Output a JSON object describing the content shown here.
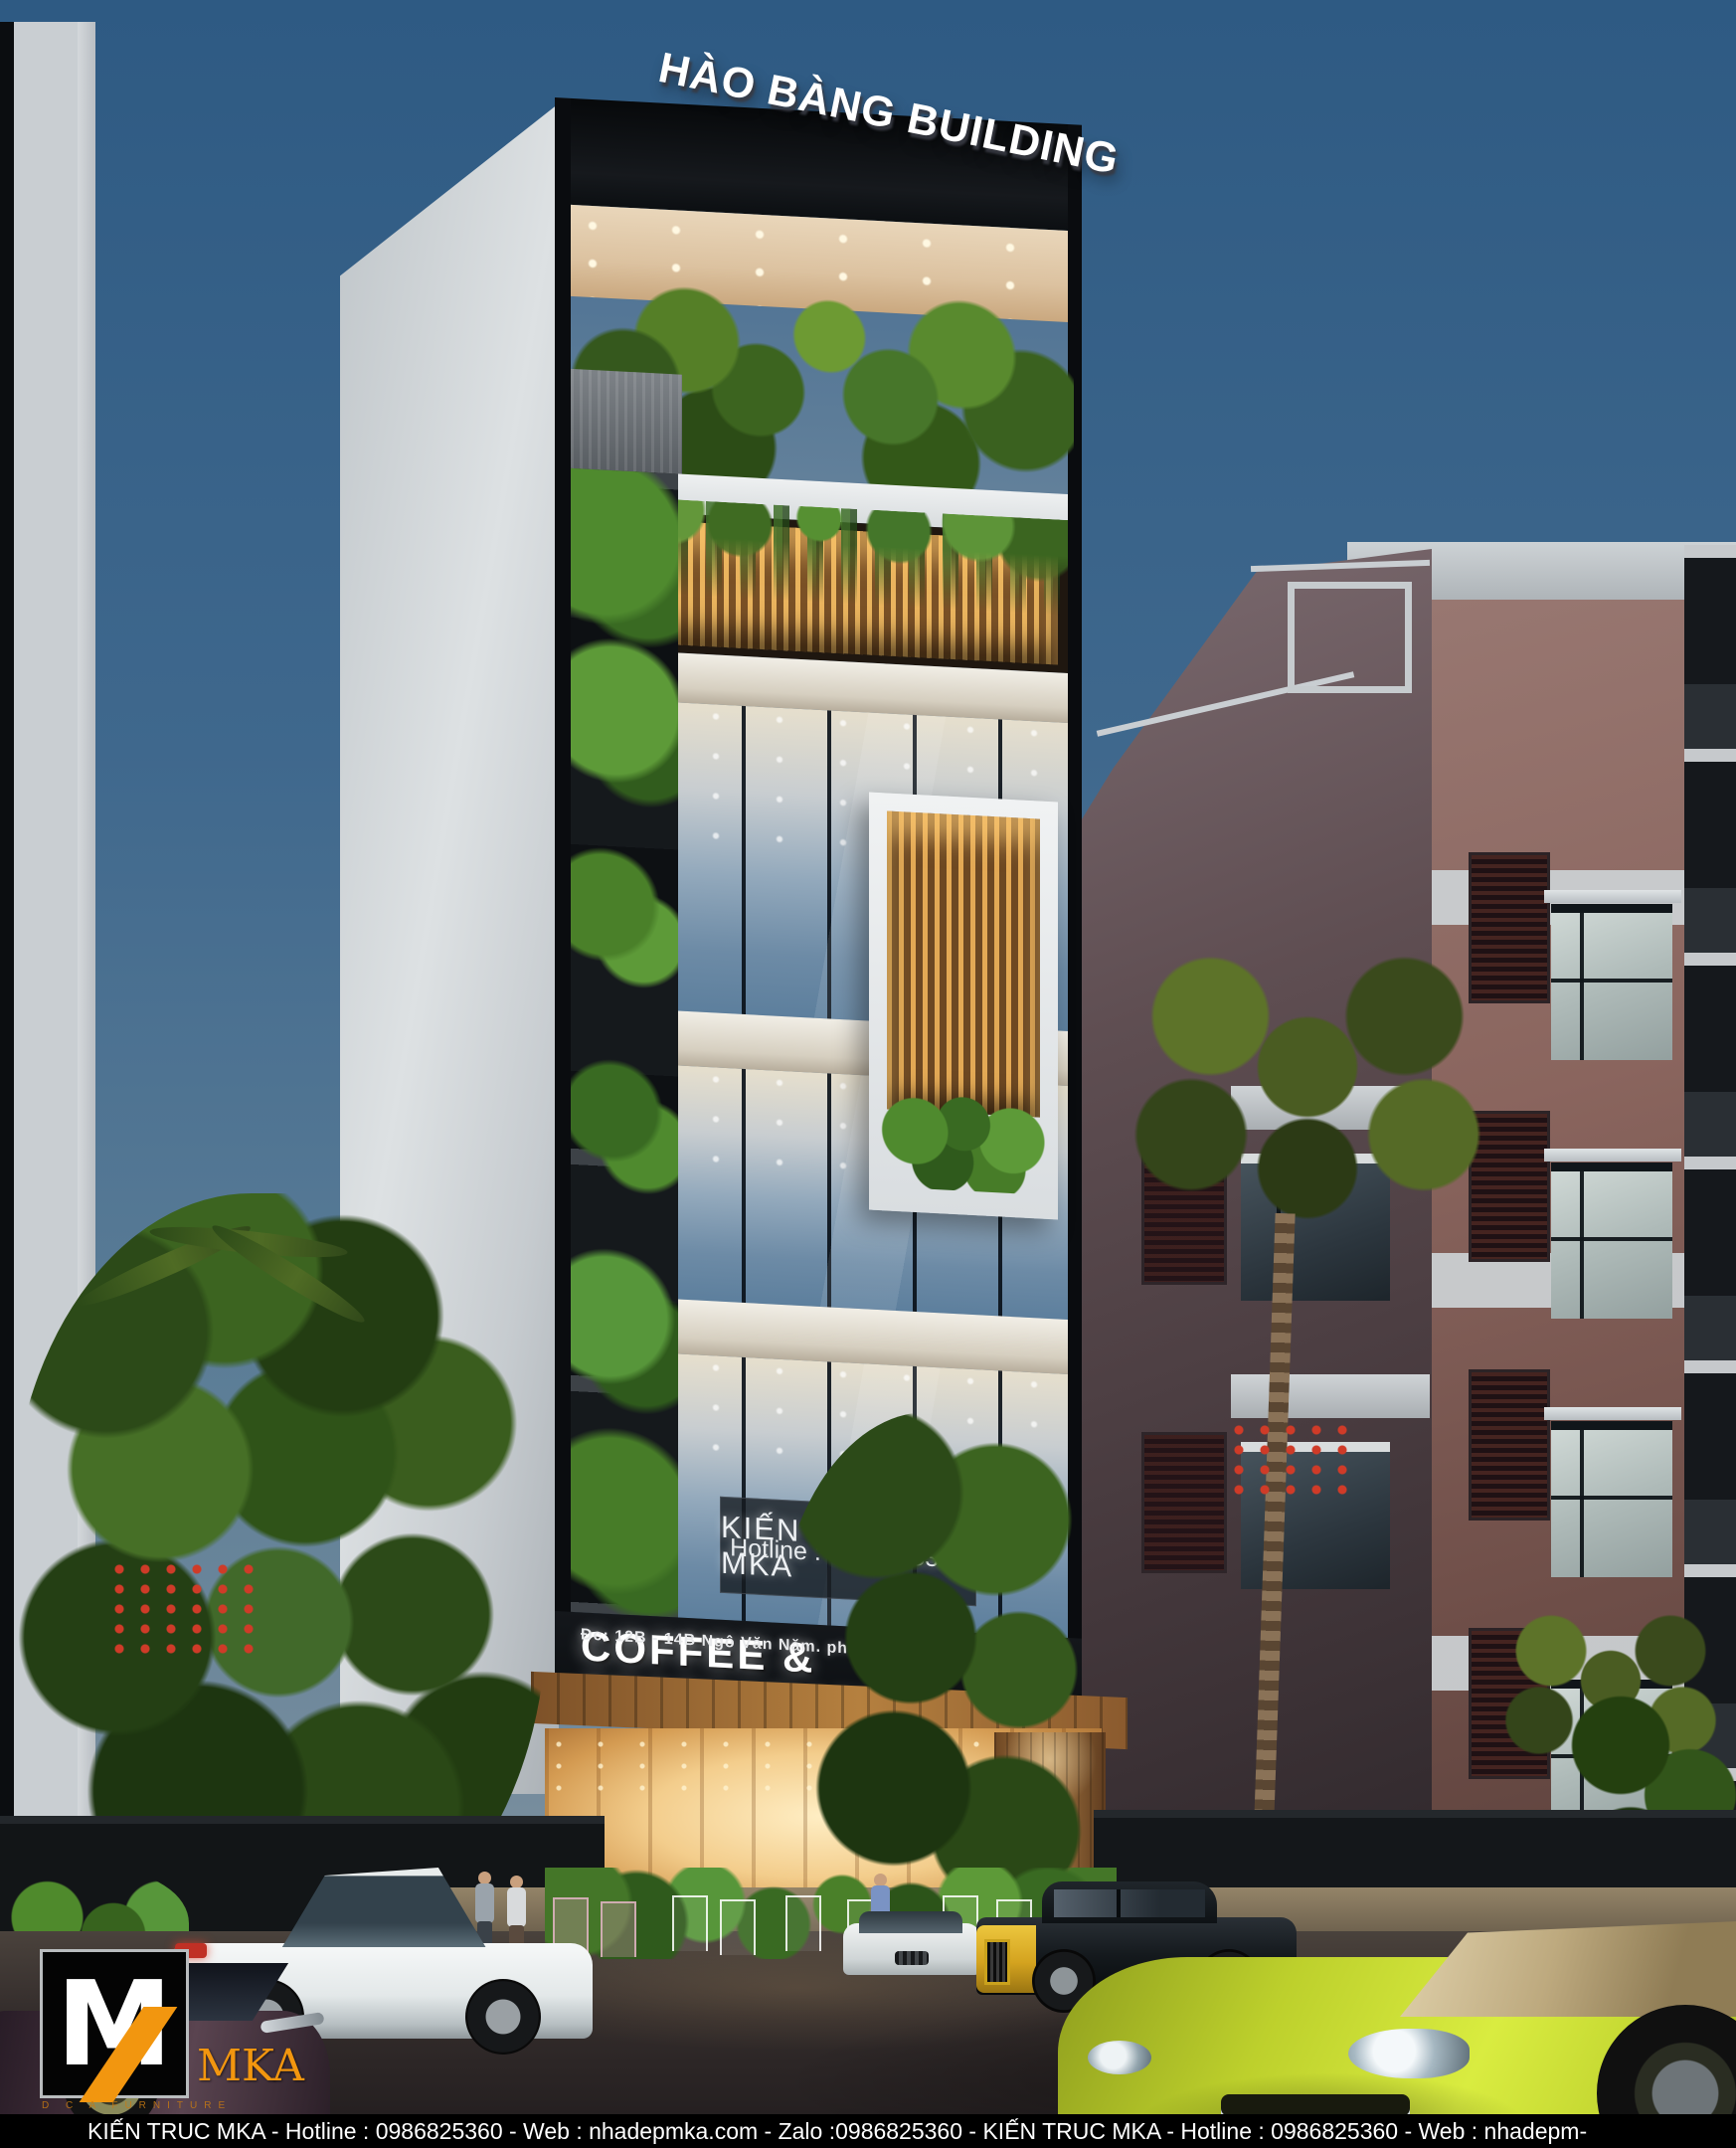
{
  "scene": "Dusk architectural rendering of a narrow green high-rise tower with glass curtain wall, rooftop garden, planted balconies, street with luxury cars and palm trees",
  "building": {
    "title": "HÀO BÀNG BUILDING",
    "glass_sign": {
      "line1": "KIẾN TRUC MKA",
      "line2": "Hotline : 0986825360"
    },
    "fascia": {
      "title": "COFFEE & RESTAURANT",
      "address": "Đc: 12B - 14B Ngô Văn Năm. phường Bến Nghé. Quận 1"
    }
  },
  "logo": {
    "text": "MKA",
    "tagline": "D C A FURNITURE"
  },
  "watermark": {
    "text": "KIẾN TRUC MKA - Hotline : 0986825360 - Web : nhadepmka.com - Zalo :0986825360 - KIẾN TRUC MKA - Hotline : 0986825360 - Web : nhadepm-"
  },
  "colors": {
    "sky_top": "#2e5a83",
    "sky_bottom": "#8c99a2",
    "accent_orange": "#f2960f",
    "louver_gold": "#eab45e",
    "porsche_green": "#c6d92f",
    "rolls_gold": "#d4a31f",
    "foliage_green": "#3c6420",
    "fascia_black": "#0d1013"
  }
}
